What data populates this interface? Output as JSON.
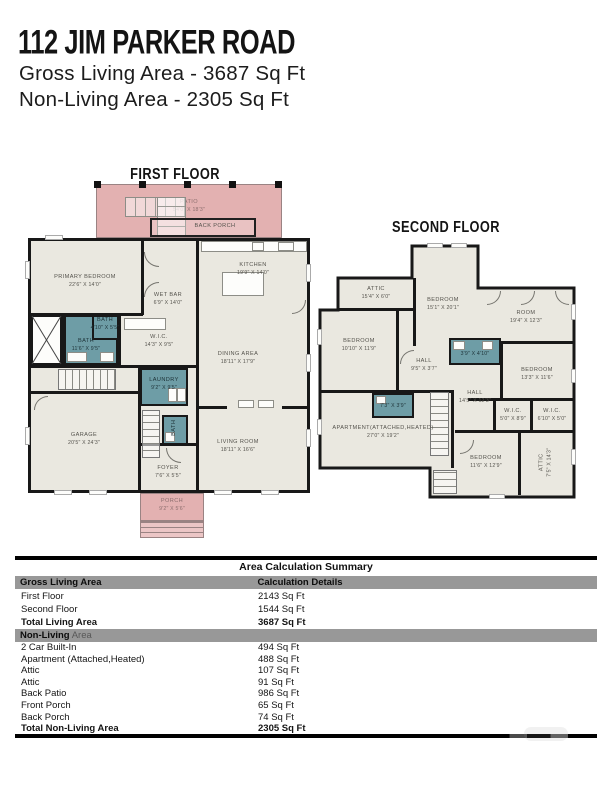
{
  "header": {
    "title": "112 JIM PARKER ROAD",
    "line1": "Gross Living Area - 3687 Sq Ft",
    "line2": "Non-Living Area - 2305 Sq Ft"
  },
  "first_floor": {
    "heading": "FIRST FLOOR",
    "patio": {
      "name": "PATIO",
      "dims": "54'0\" X 18'3\""
    },
    "back_porch": {
      "name": "BACK PORCH"
    },
    "primary_bedroom": {
      "name": "PRIMARY BEDROOM",
      "dims": "22'6\" X 14'0\""
    },
    "kitchen": {
      "name": "KITCHEN",
      "dims": "19'9\" X 14'0\""
    },
    "wet_bar": {
      "name": "WET BAR",
      "dims": "6'9\" X 14'0\""
    },
    "wic": {
      "name": "W.I.C.",
      "dims": "14'3\" X 9'5\""
    },
    "bath_small": {
      "name": "BATH",
      "dims": "4'10\" X 5'5\""
    },
    "bath_main": {
      "name": "BATH",
      "dims": "11'6\" X 9'5\""
    },
    "laundry": {
      "name": "LAUNDRY",
      "dims": "9'2\" X 9'5\""
    },
    "dining": {
      "name": "DINING AREA",
      "dims": "18'11\" X 17'9\""
    },
    "living": {
      "name": "LIVING ROOM",
      "dims": "18'11\" X 16'6\""
    },
    "garage": {
      "name": "GARAGE",
      "dims": "20'5\" X 24'3\""
    },
    "bath_powder": {
      "name": "BATH"
    },
    "foyer": {
      "name": "FOYER",
      "dims": "7'6\" X 5'5\""
    },
    "porch": {
      "name": "PORCH",
      "dims": "9'2\" X 5'6\""
    }
  },
  "second_floor": {
    "heading": "SECOND FLOOR",
    "attic_top": {
      "name": "ATTIC",
      "dims": "15'4\" X 6'0\""
    },
    "bedroom_center": {
      "name": "BEDROOM",
      "dims": "15'1\" X 20'1\""
    },
    "room": {
      "name": "ROOM",
      "dims": "19'4\" X 12'3\""
    },
    "bedroom_left": {
      "name": "BEDROOM",
      "dims": "10'10\" X 11'9\""
    },
    "hall_small": {
      "name": "HALL",
      "dims": "9'5\" X 3'7\""
    },
    "bath_center": {
      "name": "BATH",
      "dims": "3'9\" X 4'10\""
    },
    "hall_main": {
      "name": "HALL",
      "dims": "14'5\" X 12'3\""
    },
    "bedroom_right": {
      "name": "BEDROOM",
      "dims": "13'3\" X 11'6\""
    },
    "wic_left": {
      "name": "W.I.C.",
      "dims": "5'0\" X 8'9\""
    },
    "wic_right": {
      "name": "W.I.C.",
      "dims": "6'10\" X 5'0\""
    },
    "bath_apartment": {
      "name": "BATH",
      "dims": "7'3\" X 3'9\""
    },
    "apartment": {
      "name": "APARTMENT(ATTACHED,HEATED)",
      "dims": "27'0\" X 19'2\""
    },
    "bedroom_bottom": {
      "name": "BEDROOM",
      "dims": "11'6\" X 12'9\""
    },
    "attic_side": {
      "name": "ATTIC",
      "dims": "7'5\" X 14'3\""
    }
  },
  "table": {
    "title": "Area Calculation Summary",
    "col1_header": "Gross Living Area",
    "col2_header": "Calculation Details",
    "living_rows": [
      {
        "label": "First Floor",
        "value": "2143 Sq Ft"
      },
      {
        "label": "Second Floor",
        "value": "1544 Sq Ft"
      },
      {
        "label": "Total Living Area",
        "value": "3687 Sq Ft"
      }
    ],
    "nonliving_header_bold": "Non-Living",
    "nonliving_header_rest": " Area",
    "nonliving_rows": [
      {
        "label": "2 Car Built-In",
        "value": "494 Sq Ft"
      },
      {
        "label": "Apartment (Attached,Heated)",
        "value": "488 Sq Ft"
      },
      {
        "label": "Attic",
        "value": "107 Sq Ft"
      },
      {
        "label": "Attic",
        "value": "91 Sq Ft"
      },
      {
        "label": "Back Patio",
        "value": "986 Sq Ft"
      },
      {
        "label": "Front Porch",
        "value": "65 Sq Ft"
      },
      {
        "label": "Back Porch",
        "value": "74 Sq Ft"
      },
      {
        "label": "Total Non-Living Area",
        "value": "2305 Sq Ft"
      }
    ]
  }
}
